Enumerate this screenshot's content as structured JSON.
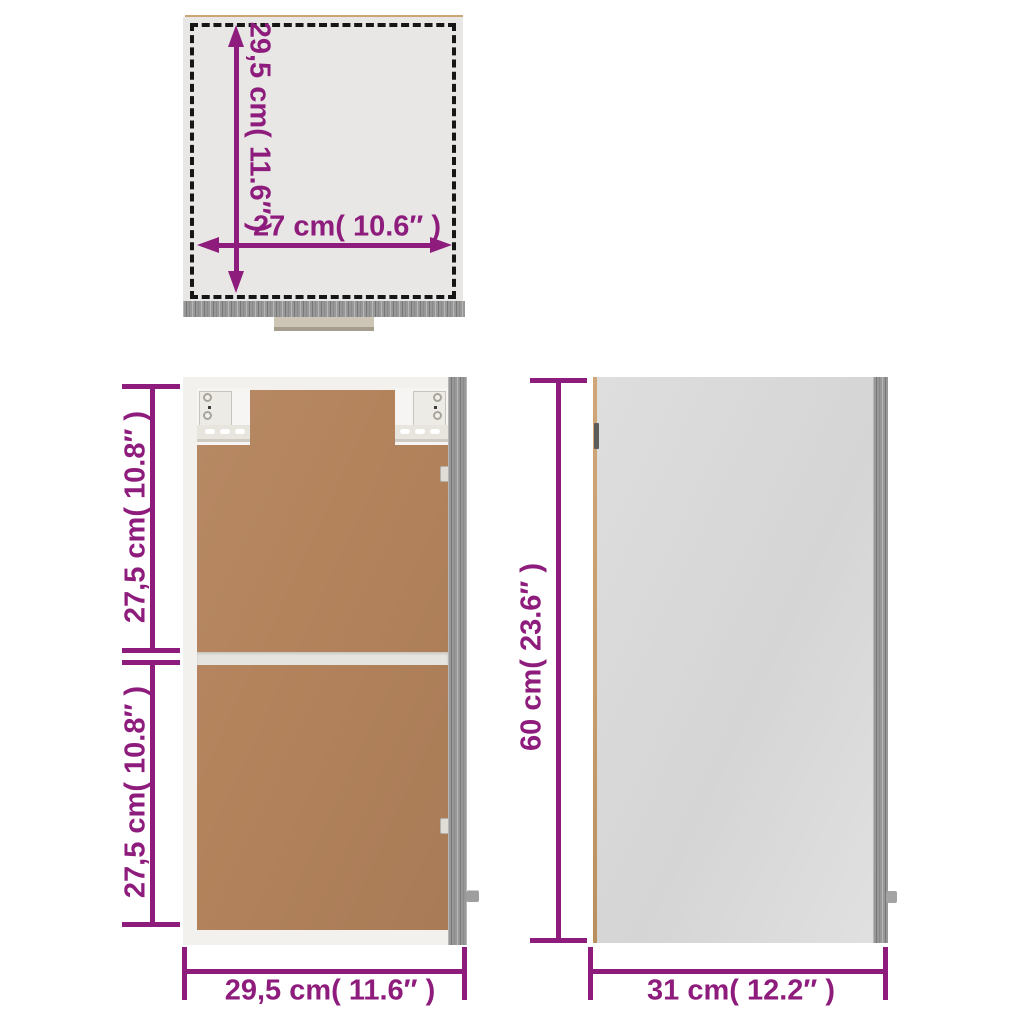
{
  "diagram": {
    "kind": "cabinet-dimension-diagram",
    "views": {
      "top_view": {
        "depth_dimension": "29,5 cm( 11.6″ )",
        "width_dimension": "27 cm( 10.6″ )"
      },
      "front_view": {
        "upper_section_dimension": "27,5 cm( 10.8″ )",
        "lower_section_dimension": "27,5 cm( 10.8″ )",
        "width_dimension": "29,5 cm( 11.6″ )"
      },
      "side_view": {
        "height_dimension": "60 cm( 23.6″ )",
        "depth_dimension": "31 cm( 12.2″ )"
      }
    },
    "colors": {
      "dimension_accent": "#8e1c7c",
      "outline_dash": "#161616",
      "frame_white": "#f2f1ee",
      "back_panel_brown": "#b3835c",
      "panel_light_gray": "#d9d9d9",
      "wood_gray": "#989898",
      "edge_tan": "#c49c6b"
    }
  }
}
